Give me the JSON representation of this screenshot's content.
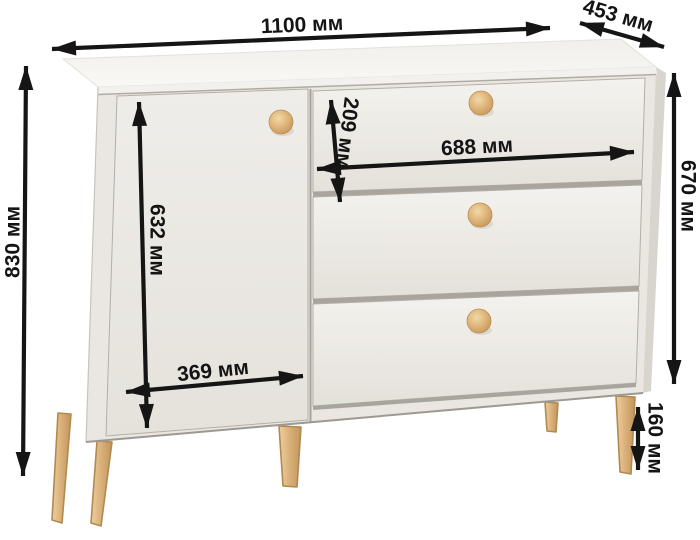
{
  "diagram": {
    "type": "furniture-dimension-diagram",
    "product": "chest of drawers with one door, three drawers, wooden knobs and splayed wooden legs",
    "unit": "мм",
    "labels": {
      "overall_width": "1100 мм",
      "depth": "453 мм",
      "overall_height": "830 мм",
      "body_height": "670 мм",
      "top_drawer_height": "209 мм",
      "drawer_front_width": "688 мм",
      "door_height": "632 мм",
      "door_width": "369 мм",
      "leg_height": "160 мм"
    },
    "values_mm": {
      "overall_width": 1100,
      "depth": 453,
      "overall_height": 830,
      "body_height": 670,
      "top_drawer_height": 209,
      "drawer_front_width": 688,
      "door_height": 632,
      "door_width": 369,
      "leg_height": 160
    },
    "colors": {
      "background": "#ffffff",
      "body": "#eae7e2",
      "top_surface": "#f8f7f4",
      "wood_accent": "#ddb277",
      "arrow": "#151515"
    }
  }
}
